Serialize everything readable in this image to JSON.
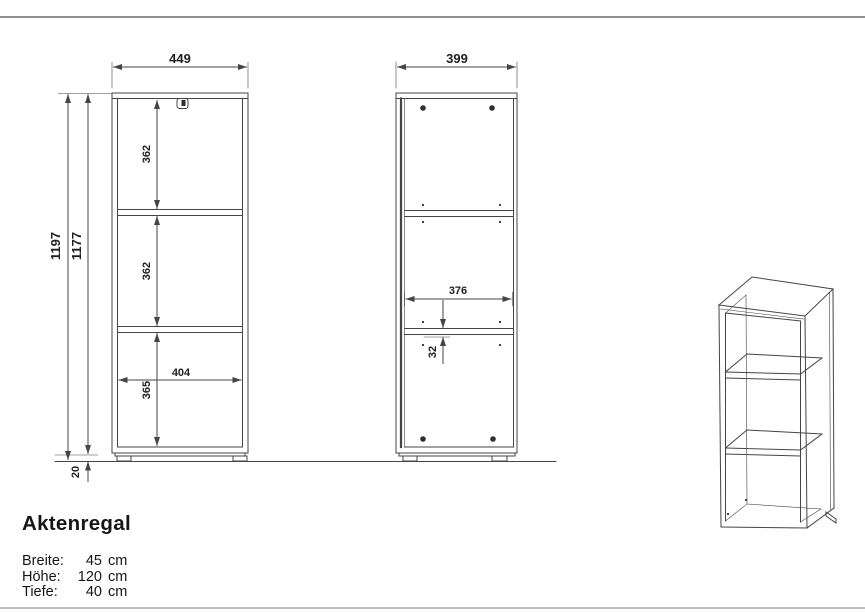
{
  "product": {
    "title": "Aktenregal",
    "specs": [
      {
        "label": "Breite:",
        "value": "45",
        "unit": "cm"
      },
      {
        "label": "Höhe:",
        "value": "120",
        "unit": "cm"
      },
      {
        "label": "Tiefe:",
        "value": "40",
        "unit": "cm"
      }
    ]
  },
  "front_view": {
    "width": "449",
    "height_total": "1197",
    "height_carcass": "1177",
    "compartment_top": "362",
    "compartment_middle": "362",
    "compartment_bottom": "365",
    "inner_width": "404",
    "foot_height": "20"
  },
  "side_view": {
    "depth": "399",
    "inner_depth": "376",
    "shelf_offset": "32"
  },
  "colors": {
    "line": "#454545",
    "text": "#1f1f1f",
    "top_border": "#8e8e93",
    "bottom_border": "#bfbfc3"
  }
}
